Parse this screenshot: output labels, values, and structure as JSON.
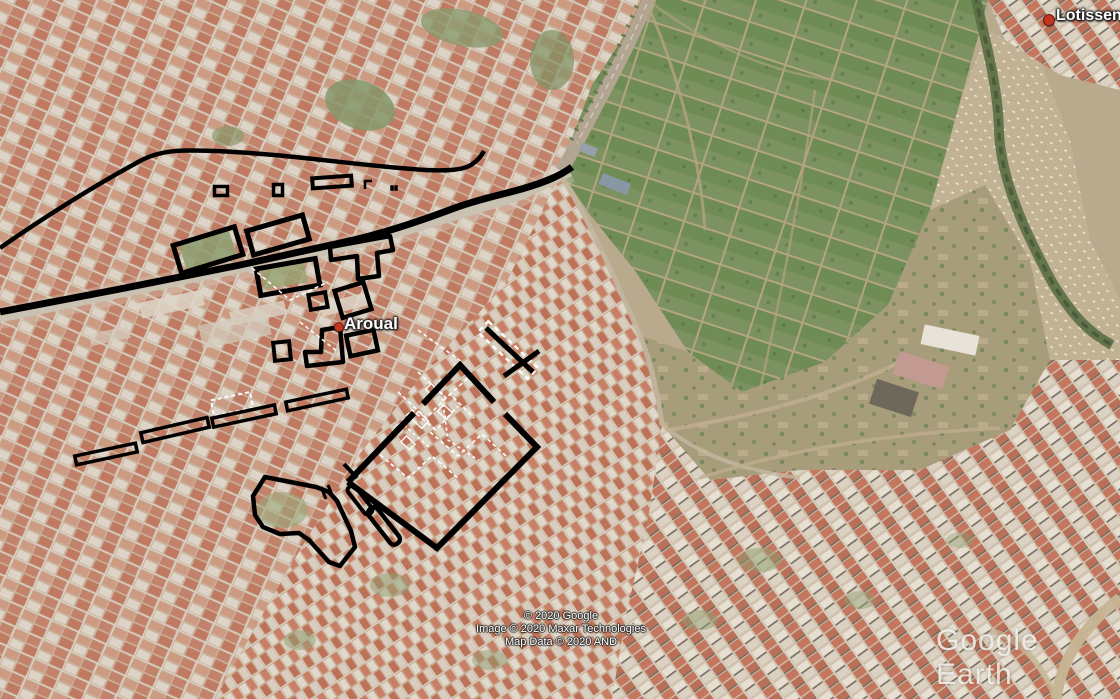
{
  "app": {
    "name": "Google Earth"
  },
  "labels": {
    "place_labels": [
      {
        "id": "aroual",
        "text": "Aroual"
      },
      {
        "id": "lotissement",
        "text": "Lotissen"
      }
    ],
    "attribution": {
      "line1": "© 2020 Google",
      "line2": "Image © 2020 Maxar Technologies",
      "line3": "Map Data © 2020 AND"
    },
    "watermark": "Google Earth"
  },
  "colors": {
    "annotation": "#000000",
    "overlay_white": "#ffffff",
    "label_text": "#ffffff",
    "pin_red": "#c2361f",
    "watermark_text": "#f2efe9"
  },
  "annotations": {
    "rects": [
      {
        "cx": 508,
        "cy": 350,
        "w": 68,
        "h": 15,
        "rot": 43,
        "sw": 2.5,
        "c": "white",
        "dash": "5 4"
      },
      {
        "cx": 232,
        "cy": 404,
        "w": 40,
        "h": 16,
        "rot": -12,
        "sw": 2,
        "c": "white",
        "dash": "4 3"
      },
      {
        "cx": 420,
        "cy": 420,
        "w": 14,
        "h": 10,
        "rot": 43,
        "sw": 1.3,
        "c": "white"
      },
      {
        "cx": 445,
        "cy": 412,
        "w": 12,
        "h": 9,
        "rot": 43,
        "sw": 1.3,
        "c": "white"
      },
      {
        "cx": 408,
        "cy": 443,
        "w": 12,
        "h": 8,
        "rot": 43,
        "sw": 1.3,
        "c": "white"
      },
      {
        "cx": 432,
        "cy": 390,
        "w": 10,
        "h": 8,
        "rot": 43,
        "sw": 1.3,
        "c": "white"
      },
      {
        "cx": 208,
        "cy": 250,
        "w": 64,
        "h": 29,
        "rot": -17,
        "sw": 5
      },
      {
        "cx": 278,
        "cy": 235,
        "w": 58,
        "h": 25,
        "rot": -16,
        "sw": 5
      },
      {
        "cx": 288,
        "cy": 277,
        "w": 60,
        "h": 27,
        "rot": -10,
        "sw": 5
      },
      {
        "cx": 318,
        "cy": 301,
        "w": 17,
        "h": 15,
        "rot": -10,
        "sw": 4
      },
      {
        "cx": 353,
        "cy": 300,
        "w": 30,
        "h": 28,
        "rot": -17,
        "sw": 4.5
      },
      {
        "cx": 282,
        "cy": 351,
        "w": 16,
        "h": 18,
        "rot": -6,
        "sw": 4
      },
      {
        "cx": 362,
        "cy": 343,
        "w": 28,
        "h": 21,
        "rot": -12,
        "sw": 4.5
      },
      {
        "cx": 106,
        "cy": 454,
        "w": 62,
        "h": 9,
        "rot": -12,
        "sw": 3.5
      },
      {
        "cx": 175,
        "cy": 430,
        "w": 68,
        "h": 10,
        "rot": -13,
        "sw": 3.5
      },
      {
        "cx": 244,
        "cy": 416,
        "w": 64,
        "h": 9,
        "rot": -12,
        "sw": 3.5
      },
      {
        "cx": 317,
        "cy": 400,
        "w": 62,
        "h": 9,
        "rot": -12,
        "sw": 3.5
      },
      {
        "cx": 332,
        "cy": 182,
        "w": 39,
        "h": 10,
        "rot": -4,
        "sw": 4
      },
      {
        "cx": 221,
        "cy": 191,
        "w": 13,
        "h": 9,
        "rot": 0,
        "sw": 3.5
      },
      {
        "cx": 278,
        "cy": 190,
        "w": 9,
        "h": 11,
        "rot": 0,
        "sw": 3.5
      },
      {
        "cx": 392,
        "cy": 188,
        "w": 3,
        "h": 5,
        "rot": 0,
        "sw": 0.5,
        "fill": "#000000"
      },
      {
        "cx": 396,
        "cy": 188,
        "w": 3,
        "h": 5,
        "rot": 0,
        "sw": 0.5,
        "fill": "#000000"
      },
      {
        "cx": 360,
        "cy": 500,
        "w": 34,
        "h": 9,
        "rot": 52,
        "sw": 4,
        "rx": 4
      },
      {
        "cx": 384,
        "cy": 526,
        "w": 44,
        "h": 11,
        "rot": 52,
        "sw": 4.5,
        "rx": 5
      }
    ],
    "polygons": [
      {
        "points": "330,247 390,236 393,250 377,253 379,276 358,279 357,256 331,260",
        "sw": 4.5
      },
      {
        "points": "322,330 340,327 343,362 307,366 305,352 321,352",
        "sw": 4.5
      },
      {
        "points": "265,477 253,496 255,515 263,527 280,534 299,533 309,540 319,551 329,562 340,566 347,557 355,547 351,531 344,516 337,501 329,492 316,487",
        "sw": 4.5
      }
    ],
    "polylines": [
      {
        "d": "M388,437 L412,410 L436,430 L458,406",
        "w": 1.6,
        "c": "white",
        "dash": "4 3"
      },
      {
        "d": "M398,392 L426,418 L450,394 L474,418",
        "w": 1.6,
        "c": "white",
        "dash": "4 3"
      },
      {
        "d": "M418,372 L446,398 L468,378 L494,404",
        "w": 1.6,
        "c": "white",
        "dash": "4 3"
      },
      {
        "d": "M380,455 L408,478 L432,456 L458,478",
        "w": 1.6,
        "c": "white",
        "dash": "4 3"
      },
      {
        "d": "M430,432 L458,456 L482,434 L506,456",
        "w": 1.6,
        "c": "white",
        "dash": "4 3"
      },
      {
        "d": "M404,425 L430,448",
        "w": 1.6,
        "c": "white",
        "dash": "3 3"
      },
      {
        "d": "M440,380 L448,440 L478,460",
        "w": 1.6,
        "c": "white",
        "dash": "3 3"
      },
      {
        "d": "M252,268 L290,300 L328,282",
        "w": 1.5,
        "c": "white",
        "dash": "4 3"
      },
      {
        "d": "M300,322 L338,352",
        "w": 1.5,
        "c": "white",
        "dash": "4 3"
      },
      {
        "d": "M418,330 L462,362",
        "w": 1.5,
        "c": "white",
        "dash": "4 3"
      },
      {
        "d": "M0,248 C40,220 92,187 140,161 C162,149 185,150 215,151 C290,154 360,166 425,170 C448,171 463,170 471,165 C477,161 481,157 484,151",
        "w": 4.5
      },
      {
        "d": "M0,312 L120,289 L240,265 L340,243 C380,235 420,221 452,209 C478,199 505,194 525,188 C545,182 560,176 572,167",
        "w": 7
      },
      {
        "d": "M348,482 L414,413 M423,404 L460,365 L494,402 M505,414 L537,447 L437,548 L348,482",
        "w": 6
      },
      {
        "d": "M486,328 L533,372",
        "w": 5
      },
      {
        "d": "M504,376 L539,351",
        "w": 5
      },
      {
        "d": "M344,464 L357,478",
        "w": 4
      },
      {
        "d": "M321,487 L326,499",
        "w": 3
      },
      {
        "d": "M328,485 L333,497",
        "w": 3
      },
      {
        "d": "M365,189 L365,181 L372,181",
        "w": 2.5
      }
    ]
  }
}
